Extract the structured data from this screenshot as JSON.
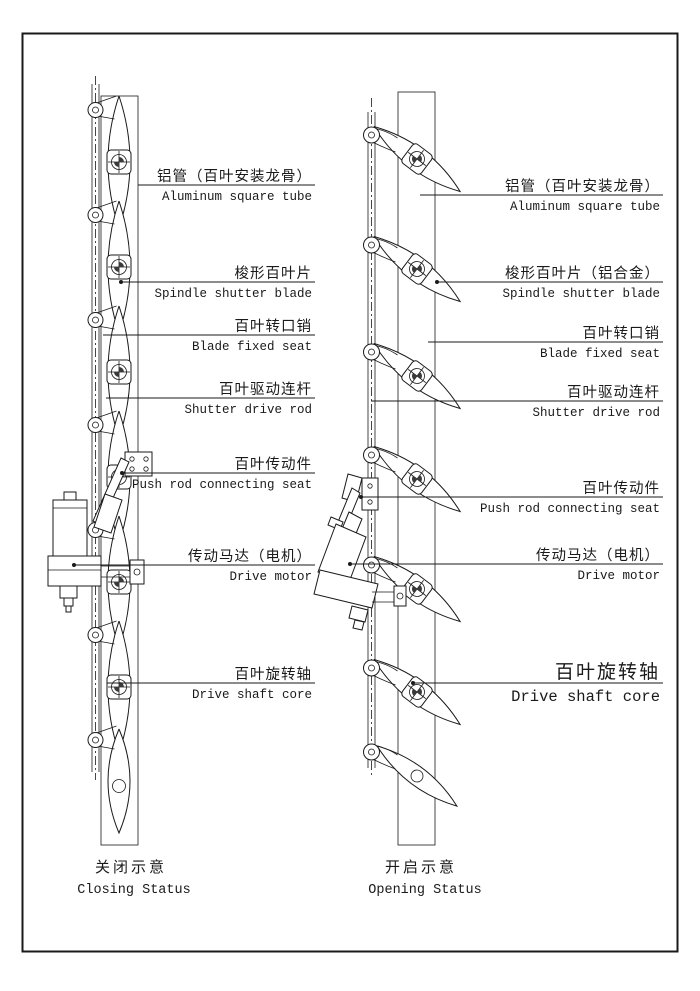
{
  "page": {
    "background_color": "#ffffff",
    "line_color": "#1a1a1a"
  },
  "left_figure": {
    "caption_zh": "关闭示意",
    "caption_en": "Closing Status",
    "labels": [
      {
        "zh": "铝管（百叶安装龙骨）",
        "en": "Aluminum square tube"
      },
      {
        "zh": "梭形百叶片",
        "en": "Spindle shutter blade"
      },
      {
        "zh": "百叶转口销",
        "en": "Blade fixed seat"
      },
      {
        "zh": "百叶驱动连杆",
        "en": "Shutter drive rod"
      },
      {
        "zh": "百叶传动件",
        "en": "Push rod connecting seat"
      },
      {
        "zh": "传动马达（电机）",
        "en": "Drive motor"
      },
      {
        "zh": "百叶旋转轴",
        "en": "Drive shaft core"
      }
    ]
  },
  "right_figure": {
    "caption_zh": "开启示意",
    "caption_en": "Opening Status",
    "labels": [
      {
        "zh": "铝管（百叶安装龙骨）",
        "en": "Aluminum square tube"
      },
      {
        "zh": "梭形百叶片（铝合金）",
        "en": "Spindle shutter blade"
      },
      {
        "zh": "百叶转口销",
        "en": "Blade fixed seat"
      },
      {
        "zh": "百叶驱动连杆",
        "en": "Shutter drive rod"
      },
      {
        "zh": "百叶传动件",
        "en": "Push rod connecting seat"
      },
      {
        "zh": "传动马达（电机）",
        "en": "Drive motor"
      },
      {
        "zh": "百叶旋转轴",
        "en": "Drive shaft core",
        "emphasis": true
      }
    ]
  }
}
